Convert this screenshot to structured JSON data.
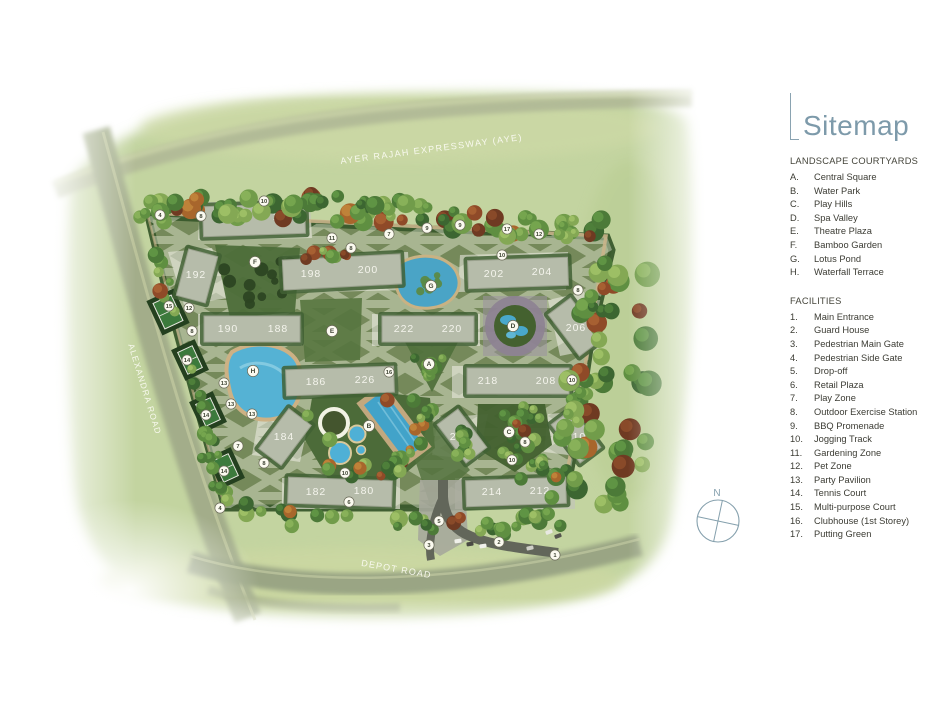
{
  "page": {
    "background": "#ffffff"
  },
  "legend": {
    "title": "Sitemap",
    "accent_color": "#7d9aaa",
    "sections": [
      {
        "heading": "LANDSCAPE COURTYARDS",
        "items": [
          {
            "key": "A.",
            "label": "Central Square"
          },
          {
            "key": "B.",
            "label": "Water Park"
          },
          {
            "key": "C.",
            "label": "Play Hills"
          },
          {
            "key": "D.",
            "label": "Spa Valley"
          },
          {
            "key": "E.",
            "label": "Theatre Plaza"
          },
          {
            "key": "F.",
            "label": "Bamboo Garden"
          },
          {
            "key": "G.",
            "label": "Lotus Pond"
          },
          {
            "key": "H.",
            "label": "Waterfall Terrace"
          }
        ]
      },
      {
        "heading": "FACILITIES",
        "items": [
          {
            "key": "1.",
            "label": "Main Entrance"
          },
          {
            "key": "2.",
            "label": "Guard House"
          },
          {
            "key": "3.",
            "label": "Pedestrian Main Gate"
          },
          {
            "key": "4.",
            "label": "Pedestrian Side Gate"
          },
          {
            "key": "5.",
            "label": "Drop-off"
          },
          {
            "key": "6.",
            "label": "Retail Plaza"
          },
          {
            "key": "7.",
            "label": "Play Zone"
          },
          {
            "key": "8.",
            "label": "Outdoor Exercise Station"
          },
          {
            "key": "9.",
            "label": "BBQ Promenade"
          },
          {
            "key": "10.",
            "label": "Jogging Track"
          },
          {
            "key": "11.",
            "label": "Gardening Zone"
          },
          {
            "key": "12.",
            "label": "Pet Zone"
          },
          {
            "key": "13.",
            "label": "Party Pavilion"
          },
          {
            "key": "14.",
            "label": "Tennis Court"
          },
          {
            "key": "15.",
            "label": "Multi-purpose Court"
          },
          {
            "key": "16.",
            "label": "Clubhouse (1st Storey)"
          },
          {
            "key": "17.",
            "label": "Putting Green"
          }
        ]
      }
    ]
  },
  "map": {
    "roads": [
      {
        "name": "AYER RAJAH EXPRESSWAY (AYE)",
        "x": 432,
        "y": 152,
        "rot": -7.5,
        "size": 9,
        "spacing": 1.4
      },
      {
        "name": "ALEXANDRA ROAD",
        "x": 142,
        "y": 390,
        "rot": 73,
        "size": 8.5,
        "spacing": 1.2
      },
      {
        "name": "DEPOT ROAD",
        "x": 396,
        "y": 572,
        "rot": 10,
        "size": 9,
        "spacing": 1.2
      }
    ],
    "buildings": [
      {
        "labels": [
          "194",
          "196"
        ],
        "cx": 254,
        "cy": 220,
        "w": 102,
        "h": 30,
        "rot": -2,
        "label_pos": [
          [
            228,
            222
          ],
          [
            283,
            220
          ]
        ]
      },
      {
        "labels": [
          "192"
        ],
        "cx": 197,
        "cy": 276,
        "w": 30,
        "h": 48,
        "rot": 15,
        "label_pos": [
          [
            196,
            278
          ]
        ]
      },
      {
        "labels": [
          "198",
          "200"
        ],
        "cx": 342,
        "cy": 272,
        "w": 118,
        "h": 30,
        "rot": -3,
        "label_pos": [
          [
            311,
            277
          ],
          [
            368,
            273
          ]
        ]
      },
      {
        "labels": [
          "202",
          "204"
        ],
        "cx": 518,
        "cy": 273,
        "w": 100,
        "h": 28,
        "rot": -2,
        "label_pos": [
          [
            494,
            277
          ],
          [
            542,
            275
          ]
        ]
      },
      {
        "labels": [
          "190",
          "188"
        ],
        "cx": 252,
        "cy": 329,
        "w": 96,
        "h": 26,
        "rot": 0,
        "label_pos": [
          [
            228,
            332
          ],
          [
            278,
            332
          ]
        ]
      },
      {
        "labels": [
          "222",
          "220"
        ],
        "cx": 428,
        "cy": 329,
        "w": 92,
        "h": 26,
        "rot": 0,
        "label_pos": [
          [
            404,
            332
          ],
          [
            452,
            332
          ]
        ]
      },
      {
        "labels": [
          "206"
        ],
        "cx": 575,
        "cy": 327,
        "w": 28,
        "h": 52,
        "rot": -37,
        "label_pos": [
          [
            576,
            331
          ]
        ]
      },
      {
        "labels": [
          "186",
          "226"
        ],
        "cx": 340,
        "cy": 381,
        "w": 108,
        "h": 26,
        "rot": -2,
        "label_pos": [
          [
            316,
            385
          ],
          [
            365,
            383
          ]
        ]
      },
      {
        "labels": [
          "218",
          "208"
        ],
        "cx": 518,
        "cy": 381,
        "w": 102,
        "h": 26,
        "rot": 0,
        "label_pos": [
          [
            488,
            384
          ],
          [
            546,
            384
          ]
        ]
      },
      {
        "labels": [
          "184"
        ],
        "cx": 285,
        "cy": 437,
        "w": 28,
        "h": 50,
        "rot": 37,
        "label_pos": [
          [
            284,
            440
          ]
        ]
      },
      {
        "labels": [
          "216"
        ],
        "cx": 462,
        "cy": 436,
        "w": 26,
        "h": 48,
        "rot": -37,
        "label_pos": [
          [
            460,
            440
          ]
        ]
      },
      {
        "labels": [
          "210"
        ],
        "cx": 576,
        "cy": 436,
        "w": 26,
        "h": 48,
        "rot": -37,
        "label_pos": [
          [
            576,
            440
          ]
        ]
      },
      {
        "labels": [
          "182",
          "180"
        ],
        "cx": 340,
        "cy": 492,
        "w": 104,
        "h": 26,
        "rot": 2,
        "label_pos": [
          [
            316,
            495
          ],
          [
            364,
            494
          ]
        ]
      },
      {
        "labels": [
          "214",
          "212"
        ],
        "cx": 516,
        "cy": 492,
        "w": 100,
        "h": 26,
        "rot": -2,
        "label_pos": [
          [
            492,
            495
          ],
          [
            540,
            494
          ]
        ]
      }
    ],
    "courtyard_markers": [
      {
        "label": "A",
        "x": 429,
        "y": 364
      },
      {
        "label": "B",
        "x": 369,
        "y": 426
      },
      {
        "label": "C",
        "x": 509,
        "y": 432
      },
      {
        "label": "D",
        "x": 513,
        "y": 326
      },
      {
        "label": "E",
        "x": 332,
        "y": 331
      },
      {
        "label": "F",
        "x": 255,
        "y": 262
      },
      {
        "label": "G",
        "x": 431,
        "y": 286
      },
      {
        "label": "H",
        "x": 253,
        "y": 371
      }
    ],
    "facility_markers": [
      {
        "label": "1",
        "x": 555,
        "y": 555
      },
      {
        "label": "2",
        "x": 499,
        "y": 542
      },
      {
        "label": "3",
        "x": 429,
        "y": 545
      },
      {
        "label": "4",
        "x": 160,
        "y": 215
      },
      {
        "label": "4",
        "x": 220,
        "y": 508
      },
      {
        "label": "5",
        "x": 439,
        "y": 521
      },
      {
        "label": "6",
        "x": 349,
        "y": 502
      },
      {
        "label": "7",
        "x": 389,
        "y": 234
      },
      {
        "label": "7",
        "x": 238,
        "y": 446
      },
      {
        "label": "8",
        "x": 201,
        "y": 216
      },
      {
        "label": "8",
        "x": 351,
        "y": 248
      },
      {
        "label": "8",
        "x": 192,
        "y": 331
      },
      {
        "label": "8",
        "x": 264,
        "y": 463
      },
      {
        "label": "8",
        "x": 525,
        "y": 442
      },
      {
        "label": "8",
        "x": 578,
        "y": 290
      },
      {
        "label": "9",
        "x": 427,
        "y": 228
      },
      {
        "label": "9",
        "x": 460,
        "y": 225
      },
      {
        "label": "10",
        "x": 264,
        "y": 201
      },
      {
        "label": "10",
        "x": 502,
        "y": 255
      },
      {
        "label": "10",
        "x": 572,
        "y": 380
      },
      {
        "label": "10",
        "x": 345,
        "y": 473
      },
      {
        "label": "10",
        "x": 512,
        "y": 460
      },
      {
        "label": "11",
        "x": 332,
        "y": 238
      },
      {
        "label": "12",
        "x": 539,
        "y": 234
      },
      {
        "label": "12",
        "x": 189,
        "y": 308
      },
      {
        "label": "13",
        "x": 224,
        "y": 383
      },
      {
        "label": "13",
        "x": 231,
        "y": 404
      },
      {
        "label": "13",
        "x": 252,
        "y": 414
      },
      {
        "label": "14",
        "x": 187,
        "y": 360
      },
      {
        "label": "14",
        "x": 206,
        "y": 415
      },
      {
        "label": "14",
        "x": 224,
        "y": 471
      },
      {
        "label": "15",
        "x": 169,
        "y": 306
      },
      {
        "label": "16",
        "x": 389,
        "y": 372
      },
      {
        "label": "17",
        "x": 507,
        "y": 229
      }
    ],
    "compass": {
      "label": "N"
    }
  }
}
